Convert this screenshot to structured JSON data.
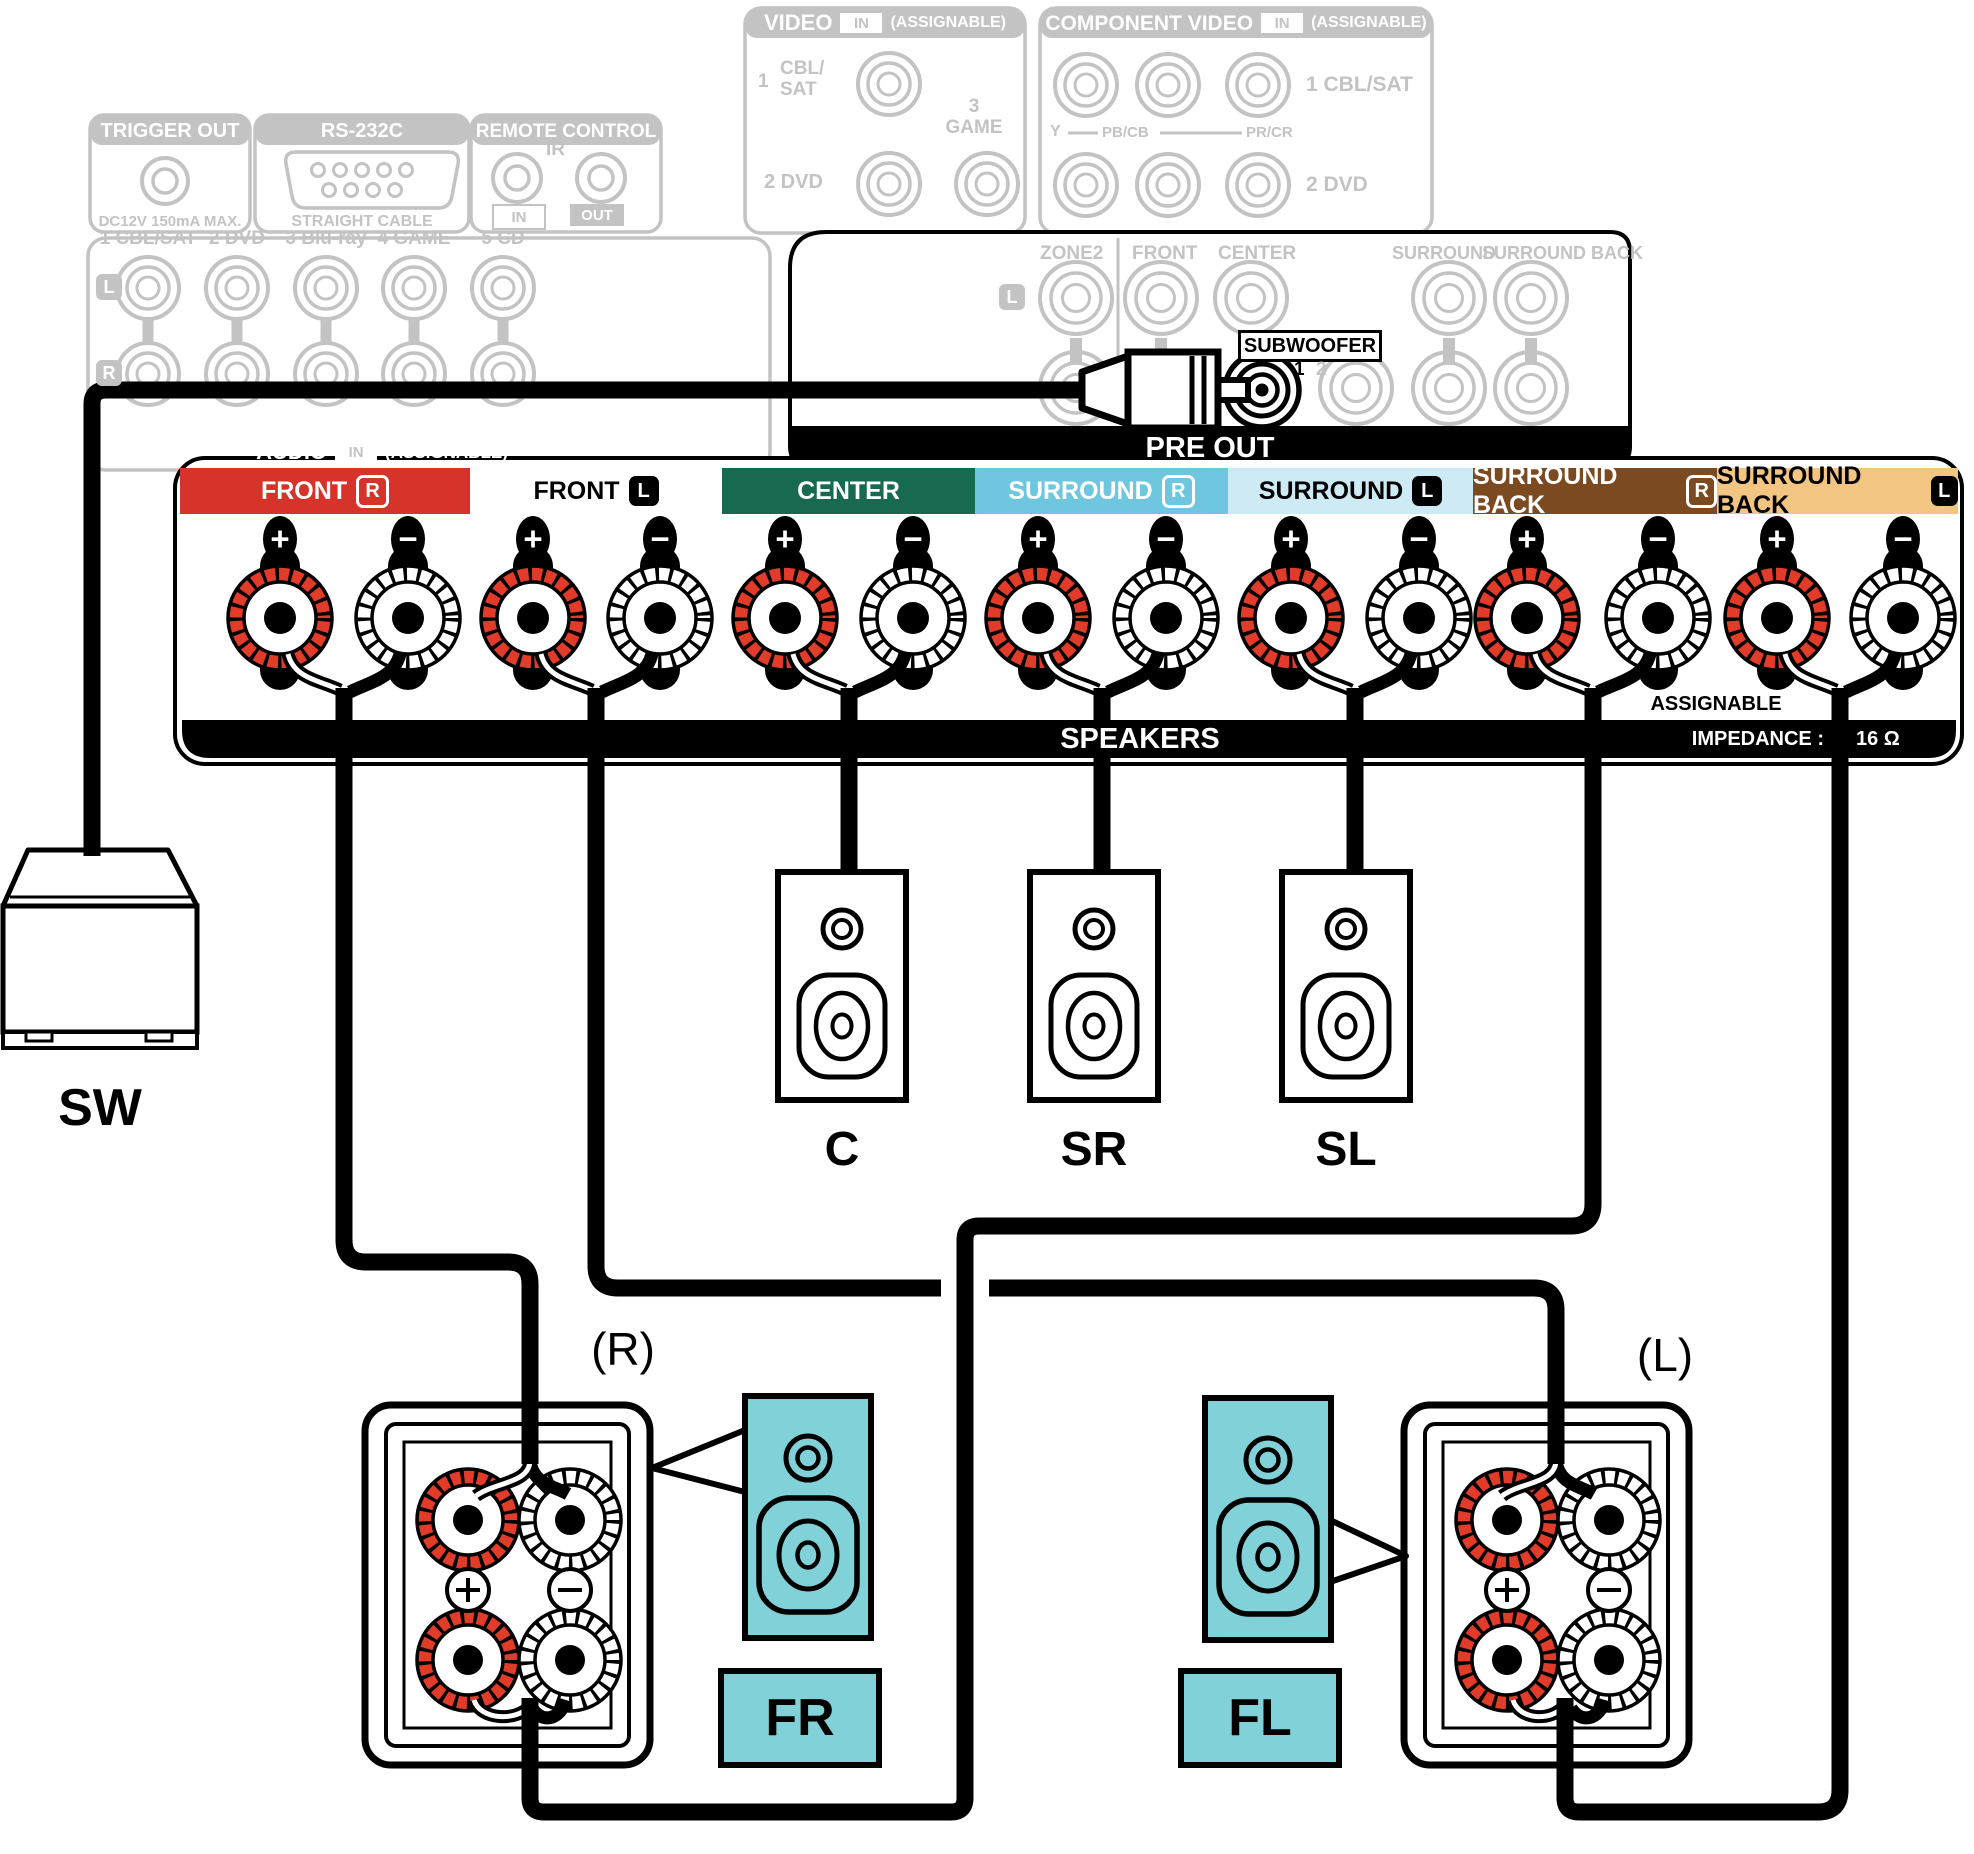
{
  "colors": {
    "faded": "#c3c3c3",
    "wire": "#000000",
    "front_r_bg": "#d6342b",
    "center_bg": "#176a50",
    "surround_r_bg": "#6ec7df",
    "surround_l_bg": "#cdeaf5",
    "surround_back_r_bg": "#7b4a21",
    "surround_back_l_bg": "#f2c583",
    "post_plus_ring": "#e13b2a",
    "speaker_teal": "#80d2d8"
  },
  "faded_panels": {
    "trigger_out": {
      "title": "TRIGGER OUT",
      "caption": "DC12V 150mA MAX."
    },
    "rs232c": {
      "title": "RS-232C",
      "caption": "STRAIGHT CABLE"
    },
    "remote_control": {
      "title": "REMOTE CONTROL",
      "ir": "IR",
      "in": "IN",
      "out": "OUT"
    },
    "audio_in": {
      "channels": [
        "1 CBL/SAT",
        "2 DVD",
        "3 Blu-ray",
        "4 GAME",
        "5 CD"
      ],
      "left": "L",
      "right": "R",
      "bar_title": "AUDIO",
      "bar_in": "IN",
      "bar_assignable": "(ASSIGNABLE)"
    },
    "video_in": {
      "title": "VIDEO",
      "in": "IN",
      "assignable": "(ASSIGNABLE)",
      "num1": "1",
      "line1a": "CBL/",
      "line1b": "SAT",
      "num3": "3",
      "label3": "GAME",
      "row2": "2 DVD"
    },
    "component_video_in": {
      "title": "COMPONENT VIDEO",
      "in": "IN",
      "assignable": "(ASSIGNABLE)",
      "row1": "1 CBL/SAT",
      "row2": "2 DVD",
      "y": "Y",
      "pb": "PB/CB",
      "pr": "PR/CR"
    }
  },
  "pre_out": {
    "title": "PRE OUT",
    "zone2": "ZONE2",
    "front": "FRONT",
    "center": "CENTER",
    "surround": "SURROUND",
    "surround_back": "SURROUND BACK",
    "left_badge": "L",
    "subwoofer": "SUBWOOFER",
    "sub1": "1",
    "sub2": "2"
  },
  "speaker_terminals": {
    "channels": [
      {
        "label": "FRONT",
        "badge": "R",
        "bg": "#d6342b",
        "text": "#ffffff",
        "badge_style": "outline"
      },
      {
        "label": "FRONT",
        "badge": "L",
        "bg": "",
        "text": "#000000",
        "badge_style": "solid"
      },
      {
        "label": "CENTER",
        "badge": "",
        "bg": "#176a50",
        "text": "#ffffff",
        "badge_style": "outline"
      },
      {
        "label": "SURROUND",
        "badge": "R",
        "bg": "#6ec7df",
        "text": "#ffffff",
        "badge_style": "outline"
      },
      {
        "label": "SURROUND",
        "badge": "L",
        "bg": "#cdeaf5",
        "text": "#000000",
        "badge_style": "solid"
      },
      {
        "label": "SURROUND BACK",
        "badge": "R",
        "bg": "#7b4a21",
        "text": "#ffffff",
        "badge_style": "outline"
      },
      {
        "label": "SURROUND BACK",
        "badge": "L",
        "bg": "#f2c583",
        "text": "#000000",
        "badge_style": "solid"
      }
    ],
    "plus": "+",
    "minus": "−",
    "assignable": "ASSIGNABLE",
    "speakers_bar": "SPEAKERS",
    "impedance_label": "IMPEDANCE :",
    "impedance_value": "16 Ω"
  },
  "speakers": {
    "sw": "SW",
    "center": "C",
    "surround_right": "SR",
    "surround_left": "SL",
    "front_right": "FR",
    "front_left": "FL",
    "right_mark": "(R)",
    "left_mark": "(L)"
  }
}
